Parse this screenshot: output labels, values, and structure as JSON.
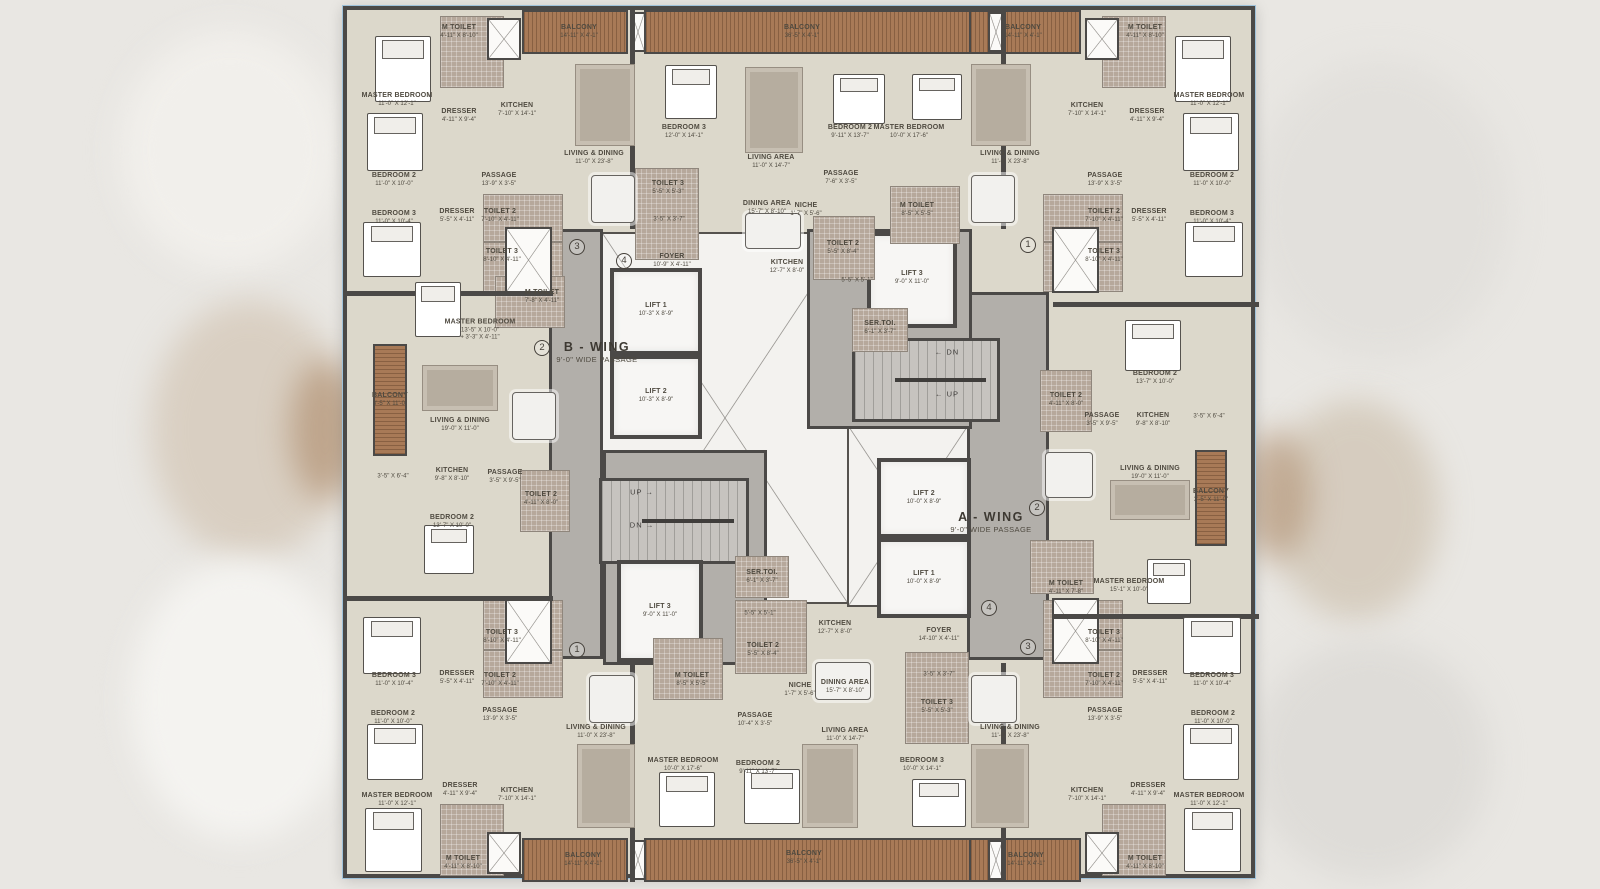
{
  "plan": {
    "wings": [
      {
        "name": "B - WING",
        "passage": "9'-0\" WIDE PASSAGE"
      },
      {
        "name": "A - WING",
        "passage": "9'-0\" WIDE PASSAGE"
      }
    ],
    "colors": {
      "wall": "#4b4947",
      "floor": "#dcd8cb",
      "corridor": "#b2afaa",
      "balcony_wood": "#a87a57",
      "toilet_tile": "#b6a89b",
      "lift": "#f7f6f4"
    },
    "rooms": [
      {
        "t": "M TOILET",
        "d": "4'-11\" X 8'-10\"",
        "x": 112,
        "y": 22
      },
      {
        "t": "BALCONY",
        "d": "14'-11\" X 4'-1\"",
        "x": 232,
        "y": 22
      },
      {
        "t": "MASTER BEDROOM",
        "d": "11'-0\" X 12'-1\"",
        "x": 50,
        "y": 90
      },
      {
        "t": "DRESSER",
        "d": "4'-11\" X 9'-4\"",
        "x": 112,
        "y": 106
      },
      {
        "t": "KITCHEN",
        "d": "7'-10\" X 14'-1\"",
        "x": 170,
        "y": 100
      },
      {
        "t": "LIVING & DINING",
        "d": "11'-0\" X 23'-8\"",
        "x": 247,
        "y": 148
      },
      {
        "t": "BEDROOM 2",
        "d": "11'-0\" X 10'-0\"",
        "x": 47,
        "y": 170
      },
      {
        "t": "PASSAGE",
        "d": "13'-9\" X 3'-5\"",
        "x": 152,
        "y": 170
      },
      {
        "t": "DRESSER",
        "d": "5'-5\" X 4'-11\"",
        "x": 110,
        "y": 206
      },
      {
        "t": "TOILET 2",
        "d": "7'-10\" X 4'-11\"",
        "x": 153,
        "y": 206
      },
      {
        "t": "BEDROOM 3",
        "d": "11'-0\" X 10'-4\"",
        "x": 47,
        "y": 208
      },
      {
        "t": "TOILET 3",
        "d": "8'-10\" X 4'-11\"",
        "x": 155,
        "y": 246
      },
      {
        "t": "M TOILET",
        "d": "7'-8\" X 4'-11\"",
        "x": 195,
        "y": 287
      },
      {
        "t": "BALCONY",
        "d": "36'-5\" X 4'-1\"",
        "x": 455,
        "y": 22
      },
      {
        "t": "BEDROOM 3",
        "d": "12'-0\" X 14'-1\"",
        "x": 337,
        "y": 122
      },
      {
        "t": "LIVING AREA",
        "d": "11'-0\" X 14'-7\"",
        "x": 424,
        "y": 152
      },
      {
        "t": "BEDROOM 2",
        "d": "9'-11\" X 13'-7\"",
        "x": 503,
        "y": 122
      },
      {
        "t": "MASTER BEDROOM",
        "d": "10'-0\" X 17'-6\"",
        "x": 562,
        "y": 122
      },
      {
        "t": "TOILET 3",
        "d": "5'-5\" X 5'-3\"",
        "x": 321,
        "y": 178
      },
      {
        "t": "",
        "d": "3'-5\" X 3'-7\"",
        "x": 322,
        "y": 210
      },
      {
        "t": "DINING AREA",
        "d": "15'-7\" X 8'-10\"",
        "x": 420,
        "y": 198
      },
      {
        "t": "NICHE",
        "d": "1'-7\" X 5'-6\"",
        "x": 459,
        "y": 200
      },
      {
        "t": "PASSAGE",
        "d": "7'-6\" X 3'-5\"",
        "x": 494,
        "y": 168
      },
      {
        "t": "M TOILET",
        "d": "8'-5\" X 5'-5\"",
        "x": 570,
        "y": 200
      },
      {
        "t": "TOILET 2",
        "d": "5'-5\" X 8'-4\"",
        "x": 496,
        "y": 238
      },
      {
        "t": "FOYER",
        "d": "10'-9\" X 4'-11\"",
        "x": 325,
        "y": 251
      },
      {
        "t": "KITCHEN",
        "d": "12'-7\" X 8'-0\"",
        "x": 440,
        "y": 257
      },
      {
        "t": "",
        "d": "5'-5\" X 5'-1\"",
        "x": 510,
        "y": 271
      },
      {
        "t": "M TOILET",
        "d": "4'-11\" X 8'-10\"",
        "x": 798,
        "y": 22
      },
      {
        "t": "BALCONY",
        "d": "14'-11\" X 4'-1\"",
        "x": 676,
        "y": 22
      },
      {
        "t": "MASTER BEDROOM",
        "d": "11'-0\" X 12'-1\"",
        "x": 862,
        "y": 90
      },
      {
        "t": "KITCHEN",
        "d": "7'-10\" X 14'-1\"",
        "x": 740,
        "y": 100
      },
      {
        "t": "DRESSER",
        "d": "4'-11\" X 9'-4\"",
        "x": 800,
        "y": 106
      },
      {
        "t": "LIVING & DINING",
        "d": "11'-0\" X 23'-8\"",
        "x": 663,
        "y": 148
      },
      {
        "t": "PASSAGE",
        "d": "13'-9\" X 3'-5\"",
        "x": 758,
        "y": 170
      },
      {
        "t": "TOILET 2",
        "d": "7'-10\" X 4'-11\"",
        "x": 757,
        "y": 206
      },
      {
        "t": "DRESSER",
        "d": "5'-5\" X 4'-11\"",
        "x": 802,
        "y": 206
      },
      {
        "t": "BEDROOM 2",
        "d": "11'-0\" X 10'-0\"",
        "x": 865,
        "y": 170
      },
      {
        "t": "BEDROOM 3",
        "d": "11'-0\" X 10'-4\"",
        "x": 865,
        "y": 208
      },
      {
        "t": "TOILET 3",
        "d": "8'-10\" X 4'-11\"",
        "x": 757,
        "y": 246
      },
      {
        "t": "LIFT 1",
        "d": "10'-3\" X 8'-9\"",
        "x": 309,
        "y": 300
      },
      {
        "t": "LIFT 2",
        "d": "10'-3\" X 8'-9\"",
        "x": 309,
        "y": 386
      },
      {
        "t": "LIFT 3",
        "d": "9'-0\" X 11'-0\"",
        "x": 565,
        "y": 268
      },
      {
        "t": "SER.TOI.",
        "d": "6'-1\" X 3'-7\"",
        "x": 533,
        "y": 318
      },
      {
        "k": "wing",
        "t": "B - WING",
        "d": "9'-0\" WIDE PASSAGE",
        "x": 250,
        "y": 342
      },
      {
        "k": "wing",
        "t": "A - WING",
        "d": "9'-0\" WIDE PASSAGE",
        "x": 644,
        "y": 512
      },
      {
        "k": "stair",
        "t": "← DN",
        "x": 600,
        "y": 342
      },
      {
        "k": "stair",
        "t": "← UP",
        "x": 600,
        "y": 384
      },
      {
        "k": "stair",
        "t": "UP →",
        "x": 295,
        "y": 482
      },
      {
        "k": "stair",
        "t": "DN →",
        "x": 295,
        "y": 515
      },
      {
        "t": "LIFT 2",
        "d": "10'-0\" X 8'-9\"",
        "x": 577,
        "y": 488
      },
      {
        "t": "LIFT 1",
        "d": "10'-0\" X 8'-9\"",
        "x": 577,
        "y": 568
      },
      {
        "t": "LIFT 3",
        "d": "9'-0\" X 11'-0\"",
        "x": 313,
        "y": 601
      },
      {
        "t": "SER.TOI.",
        "d": "6'-1\" X 3'-7\"",
        "x": 415,
        "y": 567
      },
      {
        "t": "MASTER BEDROOM",
        "d": "13'-5\" X 10'-0\"",
        "d2": "3'-3\" X 4'-11\"",
        "x": 133,
        "y": 320
      },
      {
        "t": "BALCONY",
        "d": "3'-5\" X 11'-0\"",
        "x": 43,
        "y": 390
      },
      {
        "t": "LIVING & DINING",
        "d": "19'-0\" X 11'-0\"",
        "x": 113,
        "y": 415
      },
      {
        "t": "KITCHEN",
        "d": "9'-8\" X 8'-10\"",
        "x": 105,
        "y": 465
      },
      {
        "t": "",
        "d": "3'-5\" X 6'-4\"",
        "x": 46,
        "y": 467
      },
      {
        "t": "PASSAGE",
        "d": "3'-5\" X 9'-5\"",
        "x": 158,
        "y": 467
      },
      {
        "t": "TOILET 2",
        "d": "4'-11\" X 8'-0\"",
        "x": 194,
        "y": 489
      },
      {
        "t": "BEDROOM 2",
        "d": "13'-7\" X 10'-0\"",
        "x": 105,
        "y": 512
      },
      {
        "t": "BEDROOM 2",
        "d": "13'-7\" X 10'-0\"",
        "x": 808,
        "y": 368
      },
      {
        "t": "TOILET 2",
        "d": "4'-11\" X 8'-0\"",
        "x": 719,
        "y": 390
      },
      {
        "t": "PASSAGE",
        "d": "3'-5\" X 9'-5\"",
        "x": 755,
        "y": 410
      },
      {
        "t": "KITCHEN",
        "d": "9'-8\" X 8'-10\"",
        "x": 806,
        "y": 410
      },
      {
        "t": "",
        "d": "3'-5\" X 6'-4\"",
        "x": 862,
        "y": 407
      },
      {
        "t": "LIVING & DINING",
        "d": "19'-0\" X 11'-0\"",
        "x": 803,
        "y": 463
      },
      {
        "t": "BALCONY",
        "d": "3'-5\" X 11'-0\"",
        "x": 864,
        "y": 486
      },
      {
        "t": "M TOILET",
        "d": "4'-11\" X 7'-8\"",
        "x": 719,
        "y": 578
      },
      {
        "t": "MASTER BEDROOM",
        "d": "15'-1\" X 10'-0\"",
        "x": 782,
        "y": 576
      },
      {
        "t": "TOILET 3",
        "d": "8'-10\" X 4'-11\"",
        "x": 155,
        "y": 627
      },
      {
        "t": "DRESSER",
        "d": "5'-5\" X 4'-11\"",
        "x": 110,
        "y": 668
      },
      {
        "t": "TOILET 2",
        "d": "7'-10\" X 4'-11\"",
        "x": 153,
        "y": 670
      },
      {
        "t": "BEDROOM 3",
        "d": "11'-0\" X 10'-4\"",
        "x": 47,
        "y": 670
      },
      {
        "t": "PASSAGE",
        "d": "13'-9\" X 3'-5\"",
        "x": 153,
        "y": 705
      },
      {
        "t": "BEDROOM 2",
        "d": "11'-0\" X 10'-0\"",
        "x": 46,
        "y": 708
      },
      {
        "t": "LIVING & DINING",
        "d": "11'-0\" X 23'-8\"",
        "x": 249,
        "y": 722
      },
      {
        "t": "MASTER BEDROOM",
        "d": "11'-0\" X 12'-1\"",
        "x": 50,
        "y": 790
      },
      {
        "t": "DRESSER",
        "d": "4'-11\" X 9'-4\"",
        "x": 113,
        "y": 780
      },
      {
        "t": "KITCHEN",
        "d": "7'-10\" X 14'-1\"",
        "x": 170,
        "y": 785
      },
      {
        "t": "M TOILET",
        "d": "4'-11\" X 8'-10\"",
        "x": 116,
        "y": 853
      },
      {
        "t": "BALCONY",
        "d": "14'-11\" X 4'-1\"",
        "x": 236,
        "y": 850
      },
      {
        "t": "",
        "d": "5'-5\" X 5'-1\"",
        "x": 413,
        "y": 604
      },
      {
        "t": "KITCHEN",
        "d": "12'-7\" X 8'-0\"",
        "x": 488,
        "y": 618
      },
      {
        "t": "TOILET 2",
        "d": "5'-5\" X 8'-4\"",
        "x": 416,
        "y": 640
      },
      {
        "t": "M TOILET",
        "d": "8'-5\" X 5'-5\"",
        "x": 345,
        "y": 670
      },
      {
        "t": "NICHE",
        "d": "1'-7\" X 5'-6\"",
        "x": 453,
        "y": 680
      },
      {
        "t": "DINING AREA",
        "d": "15'-7\" X 8'-10\"",
        "x": 498,
        "y": 677
      },
      {
        "t": "FOYER",
        "d": "14'-10\" X 4'-11\"",
        "x": 592,
        "y": 625
      },
      {
        "t": "PASSAGE",
        "d": "10'-4\" X 3'-5\"",
        "x": 408,
        "y": 710
      },
      {
        "t": "MASTER BEDROOM",
        "d": "10'-0\" X 17'-6\"",
        "x": 336,
        "y": 755
      },
      {
        "t": "BEDROOM 2",
        "d": "9'-11\" X 13'-7\"",
        "x": 411,
        "y": 758
      },
      {
        "t": "LIVING AREA",
        "d": "11'-0\" X 14'-7\"",
        "x": 498,
        "y": 725
      },
      {
        "t": "BEDROOM 3",
        "d": "10'-0\" X 14'-1\"",
        "x": 575,
        "y": 755
      },
      {
        "t": "TOILET 3",
        "d": "5'-5\" X 5'-3\"",
        "x": 590,
        "y": 697
      },
      {
        "t": "",
        "d": "3'-5\" X 3'-7\"",
        "x": 592,
        "y": 665
      },
      {
        "t": "BALCONY",
        "d": "36'-5\" X 4'-1\"",
        "x": 457,
        "y": 848
      },
      {
        "t": "TOILET 3",
        "d": "8'-10\" X 4'-11\"",
        "x": 757,
        "y": 627
      },
      {
        "t": "TOILET 2",
        "d": "7'-10\" X 4'-11\"",
        "x": 757,
        "y": 670
      },
      {
        "t": "DRESSER",
        "d": "5'-5\" X 4'-11\"",
        "x": 803,
        "y": 668
      },
      {
        "t": "BEDROOM 3",
        "d": "11'-0\" X 10'-4\"",
        "x": 865,
        "y": 670
      },
      {
        "t": "BEDROOM 2",
        "d": "11'-0\" X 10'-0\"",
        "x": 866,
        "y": 708
      },
      {
        "t": "PASSAGE",
        "d": "13'-9\" X 3'-5\"",
        "x": 758,
        "y": 705
      },
      {
        "t": "LIVING & DINING",
        "d": "11'-0\" X 23'-8\"",
        "x": 663,
        "y": 722
      },
      {
        "t": "KITCHEN",
        "d": "7'-10\" X 14'-1\"",
        "x": 740,
        "y": 785
      },
      {
        "t": "DRESSER",
        "d": "4'-11\" X 9'-4\"",
        "x": 801,
        "y": 780
      },
      {
        "t": "MASTER BEDROOM",
        "d": "11'-0\" X 12'-1\"",
        "x": 862,
        "y": 790
      },
      {
        "t": "M TOILET",
        "d": "4'-11\" X 8'-10\"",
        "x": 798,
        "y": 853
      },
      {
        "t": "BALCONY",
        "d": "14'-11\" X 4'-1\"",
        "x": 679,
        "y": 850
      }
    ],
    "markers": [
      {
        "g": "③",
        "x": 230,
        "y": 237
      },
      {
        "g": "④",
        "x": 277,
        "y": 251
      },
      {
        "g": "①",
        "x": 681,
        "y": 235
      },
      {
        "g": "②",
        "x": 195,
        "y": 338
      },
      {
        "g": "②",
        "x": 690,
        "y": 498
      },
      {
        "g": "④",
        "x": 642,
        "y": 598
      },
      {
        "g": "③",
        "x": 681,
        "y": 637
      },
      {
        "g": "①",
        "x": 230,
        "y": 640
      }
    ]
  }
}
